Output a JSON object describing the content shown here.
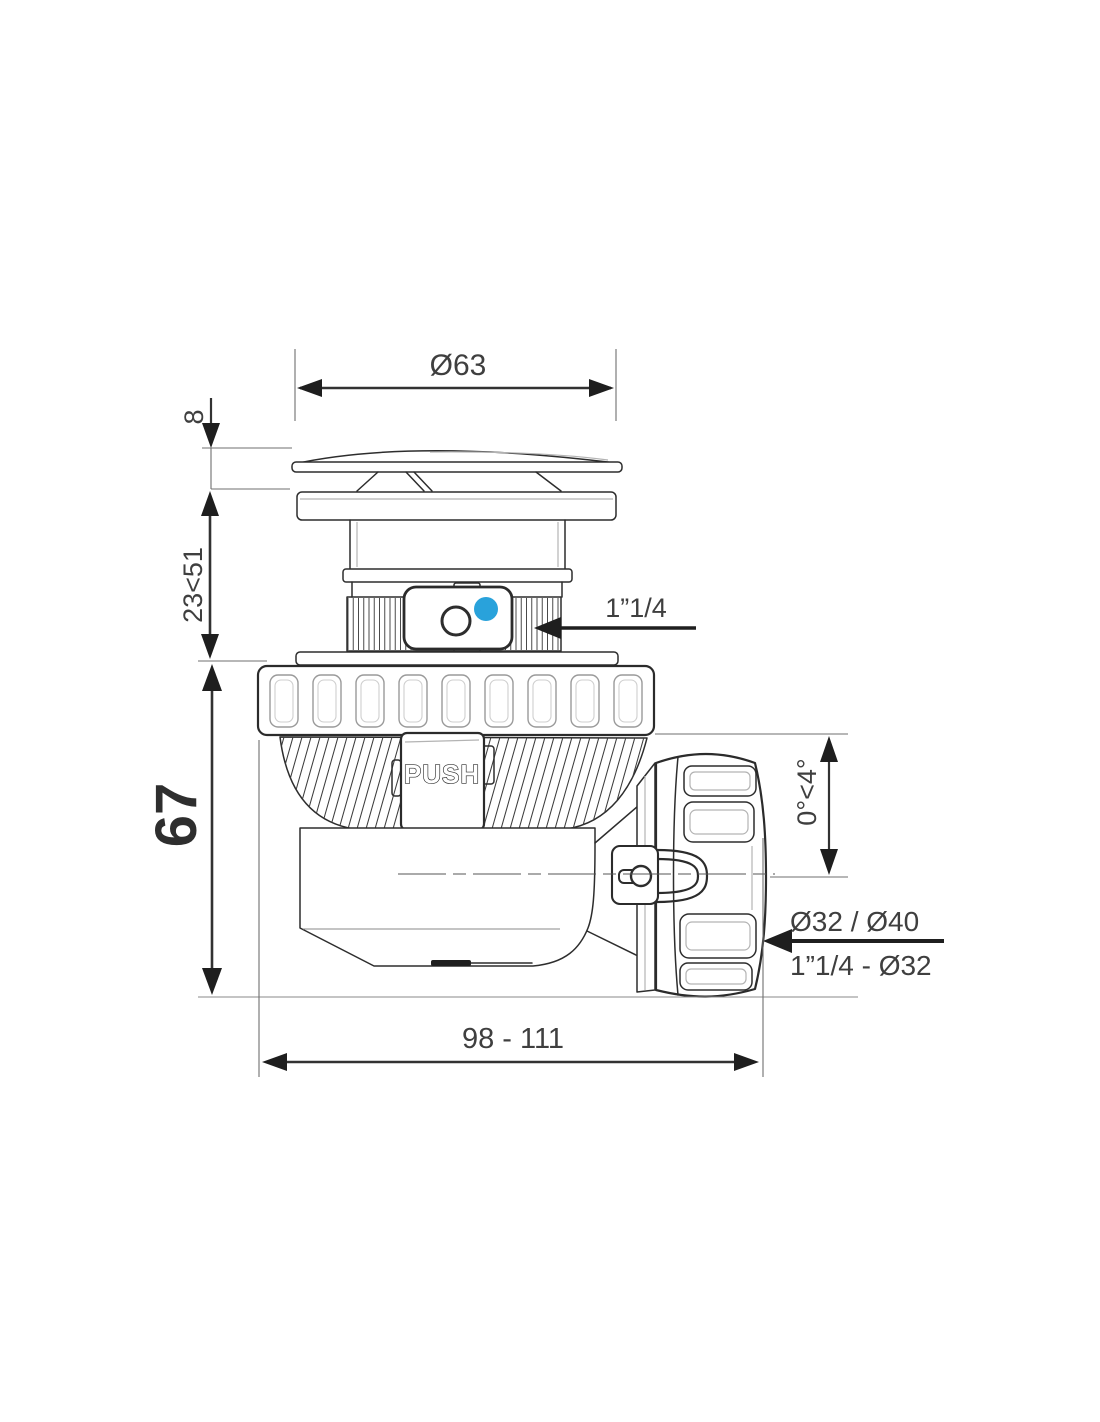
{
  "drawing": {
    "labels": {
      "cap_diameter": "Ø63",
      "cap_height": "8",
      "adjustable_height": "23<51",
      "body_height": "67",
      "inlet_thread": "1”1/4",
      "push": "PUSH",
      "outlet_angle": "0°<4°",
      "outlet_sizes": "Ø32 / Ø40",
      "outlet_thread": "1”1/4 - Ø32",
      "overall_length": "98 - 111"
    },
    "colors": {
      "line": "#2d2d2d",
      "dimension": "#3f3f3f",
      "accent_blue": "#29a2db",
      "background": "#ffffff"
    }
  }
}
